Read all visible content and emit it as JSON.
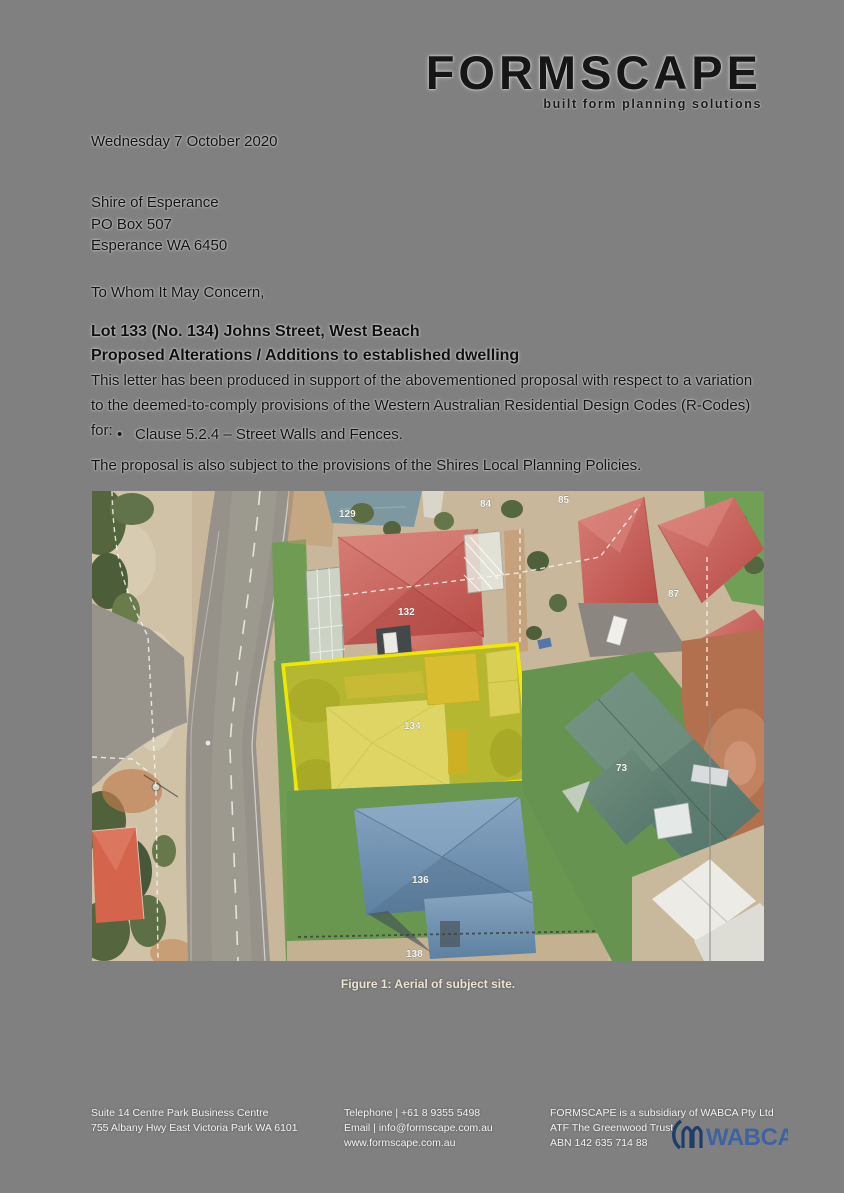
{
  "page": {
    "background": "#808080"
  },
  "logo": {
    "wordmark": "FORMSCAPE",
    "tagline": "built form planning solutions"
  },
  "letter": {
    "date": "Wednesday 7 October 2020",
    "recipient": [
      "Shire of Esperance",
      "PO Box 507",
      "Esperance WA 6450"
    ],
    "salutation": "To Whom It May Concern,",
    "subject_line1": "Lot 133 (No. 134) Johns Street, West Beach",
    "subject_line2": "Proposed Alterations / Additions to established dwelling",
    "body_paragraph": "This letter has been produced in support of the abovementioned proposal with respect to a variation to the deemed-to-comply provisions of the Western Australian Residential Design Codes (R-Codes) for:",
    "bullet_char": "•",
    "bullet_items": [
      "Clause 5.2.4 – Street Walls and Fences."
    ],
    "closing_paragraph": "The proposal is also subject to the provisions of the Shires Local Planning Policies."
  },
  "figure": {
    "caption": "Figure 1: Aerial of subject site.",
    "highlight_color": "#f2ea00",
    "labels": {
      "l129": "129",
      "l84": "84",
      "l85": "85",
      "l87": "87",
      "l132": "132",
      "l134": "134",
      "l136": "136",
      "l73": "73",
      "l138": "138"
    }
  },
  "footer": {
    "address_line1": "Suite 14 Centre Park Business Centre",
    "address_line2": "755 Albany Hwy East Victoria Park WA 6101",
    "telephone": "Telephone | +61 8 9355 5498",
    "email": "Email | info@formscape.com.au",
    "website": "www.formscape.com.au",
    "company_line1": "FORMSCAPE is a subsidiary of WABCA Pty Ltd",
    "company_line2": "ATF The Greenwood Trust",
    "company_line3": "ABN 142 635 714 88",
    "wabca_logo_text": "WABCA"
  }
}
